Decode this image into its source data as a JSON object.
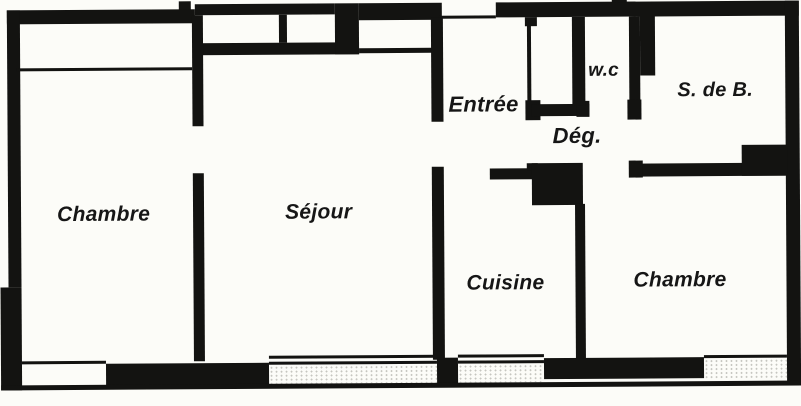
{
  "rooms": {
    "bedroom1": {
      "label": "Chambre"
    },
    "living": {
      "label": "Séjour"
    },
    "entry": {
      "label": "Entrée"
    },
    "wc": {
      "label": "w.c"
    },
    "bathroom": {
      "label": "S. de B."
    },
    "hallway": {
      "label": "Dég."
    },
    "kitchen": {
      "label": "Cuisine"
    },
    "bedroom2": {
      "label": "Chambre"
    }
  },
  "colors": {
    "wall": "#131311",
    "background": "#fcfcf8"
  }
}
